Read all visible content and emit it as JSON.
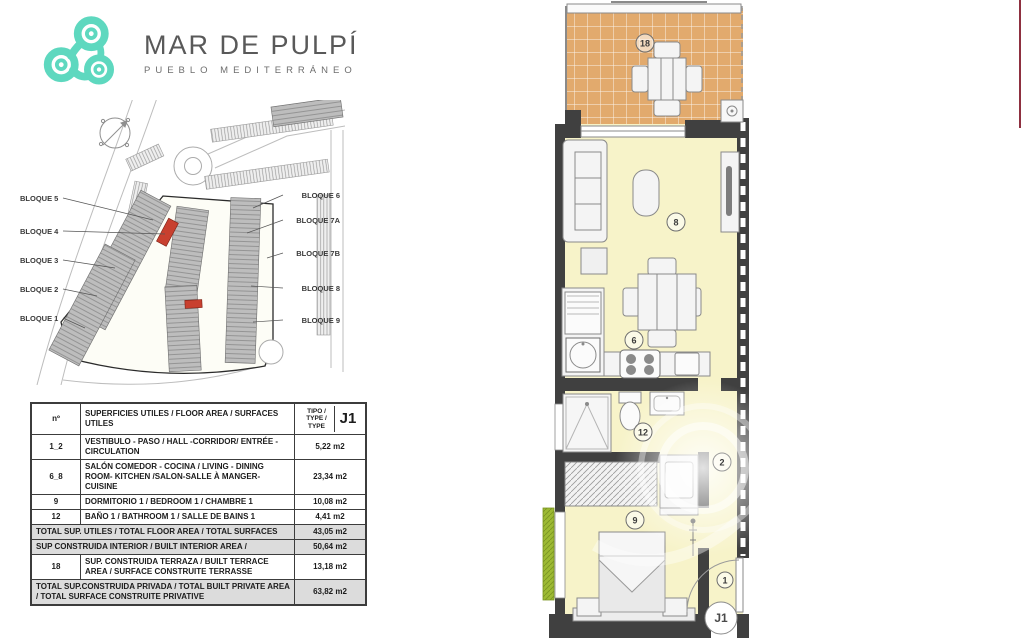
{
  "brand": {
    "name": "MAR DE PULPÍ",
    "tagline": "PUEBLO MEDITERRÁNEO",
    "logo_color": "#5ed8bf"
  },
  "site_plan": {
    "left_labels": [
      "BLOQUE 5",
      "BLOQUE 4",
      "BLOQUE 3",
      "BLOQUE 2",
      "BLOQUE 1"
    ],
    "right_labels": [
      "BLOQUE 6",
      "BLOQUE 7A",
      "BLOQUE 7B",
      "BLOQUE 8",
      "BLOQUE 9"
    ],
    "highlight_color": "#c8402f"
  },
  "areas_table": {
    "header": {
      "no": "nº",
      "desc": "SUPERFICIES UTILES / FLOOR AREA / SURFACES UTILES",
      "tipo": "TIPO / TYPE / TYPE",
      "type_value": "J1"
    },
    "rows": [
      {
        "no": "1_2",
        "desc": "VESTIBULO - PASO / HALL -CORRIDOR/ ENTRÉE - CIRCULATION",
        "area": "5,22 m2"
      },
      {
        "no": "6_8",
        "desc": "SALÓN COMEDOR - COCINA / LIVING - DINING ROOM- KITCHEN /SALON-SALLE À MANGER-CUISINE",
        "area": "23,34 m2"
      },
      {
        "no": "9",
        "desc": "DORMITORIO 1 / BEDROOM 1 / CHAMBRE 1",
        "area": "10,08 m2"
      },
      {
        "no": "12",
        "desc": "BAÑO 1 / BATHROOM 1 / SALLE DE BAINS 1",
        "area": "4,41 m2"
      },
      {
        "no": "",
        "desc": "TOTAL SUP. UTILES / TOTAL FLOOR AREA / TOTAL SURFACES",
        "area": "43,05 m2"
      },
      {
        "no": "",
        "desc": "SUP CONSTRUIDA INTERIOR / BUILT INTERIOR AREA /",
        "area": "50,64 m2"
      },
      {
        "no": "18",
        "desc": "SUP. CONSTRUIDA TERRAZA / BUILT TERRACE AREA / SURFACE CONSTRUITE TERRASSE",
        "area": "13,18 m2"
      },
      {
        "no": "",
        "desc": "TOTAL SUP.CONSTRUIDA PRIVADA / TOTAL  BUILT PRIVATE AREA / TOTAL SURFACE CONSTRUITE PRIVATIVE",
        "area": "63,82 m2"
      }
    ]
  },
  "floor_plan": {
    "labels": {
      "terrace": "18",
      "living": "8",
      "dining_kitchen": "6",
      "bathroom": "12",
      "hall": "2",
      "bedroom": "9",
      "entrance": "1",
      "unit_type": "J1"
    },
    "colors": {
      "floor": "#f7f3c9",
      "terrace": "#e2aa6d",
      "wall": "#404040",
      "garden": "#8fae2d"
    }
  }
}
